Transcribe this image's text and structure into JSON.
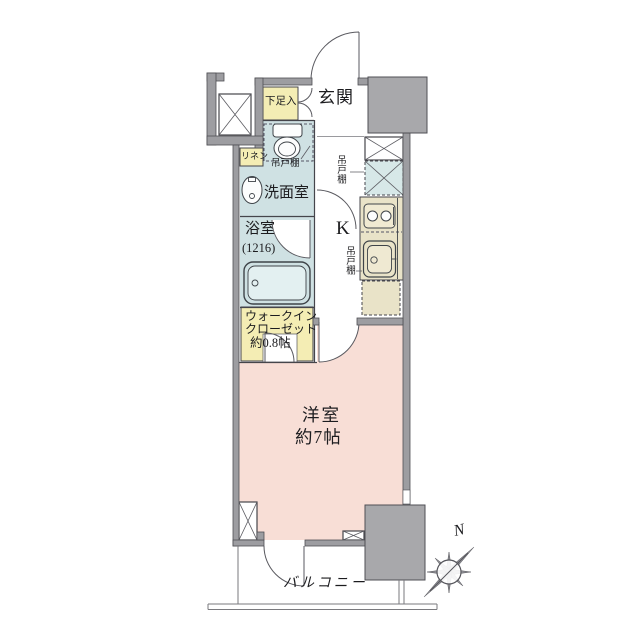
{
  "plan": {
    "colors": {
      "wall": "#9d9da1",
      "wall_outline": "#4f4f54",
      "pillar_block": "#a8a8ab",
      "room_pink": "#f8ded6",
      "wet_area_blue": "#cfe1e3",
      "storage_yellow": "#f4edb4",
      "kitchen_beige": "#e9e3c8",
      "cupboard_dashed_blue": "#d7e8e8",
      "line": "#45454b"
    },
    "rooms": {
      "genkan": {
        "label": "玄関"
      },
      "shoe_box": {
        "label": "下足入"
      },
      "linen": {
        "label": "リネン"
      },
      "hanging_cupboard_toilet": {
        "label": "吊戸棚"
      },
      "hanging_cupboard_entry": {
        "label": "吊戸棚"
      },
      "hanging_cupboard_kitchen": {
        "label": "吊戸棚"
      },
      "washroom": {
        "label": "洗面室"
      },
      "bath": {
        "label": "浴室",
        "size": "(1216)"
      },
      "kitchen": {
        "label": "K"
      },
      "walk_in_closet": {
        "label_line1": "ウォークイン",
        "label_line2": "クローゼット",
        "size": "約0.8帖"
      },
      "western_room": {
        "label": "洋室",
        "size": "約7帖"
      },
      "balcony": {
        "label": "バルコニー"
      }
    },
    "compass": {
      "north_label": "N"
    }
  }
}
